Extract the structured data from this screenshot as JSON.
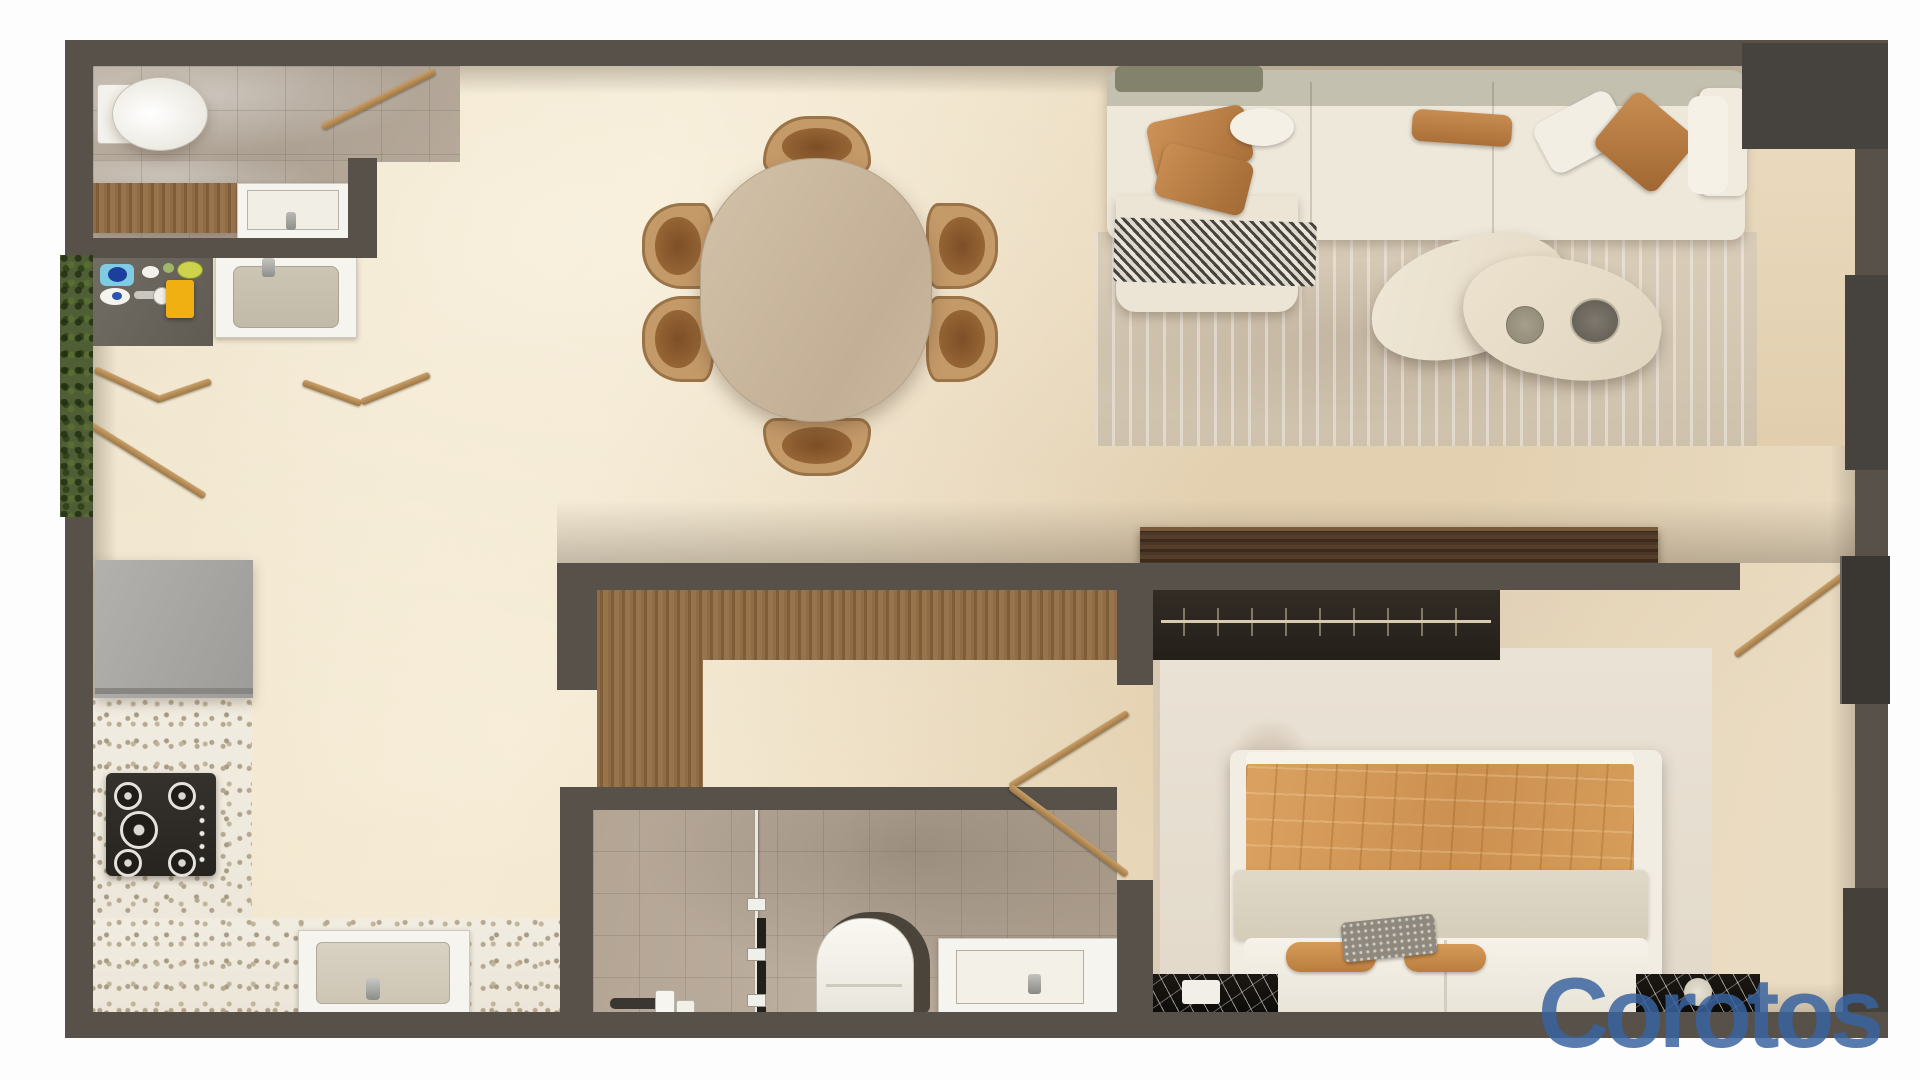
{
  "watermark": {
    "text": "Corotos",
    "color": "#3863a0"
  },
  "palette": {
    "wall": "#57514a",
    "floor_beige": "#ebdcbf",
    "bath_tile": "#b5a99c",
    "wood_door": "#b78a4e",
    "wood_floor": "#8d6b45",
    "walnut_console": "#4b3727",
    "terrazzo": "#f0ebe1",
    "sofa_cream": "#eee8da",
    "pillow_tan": "#c08449",
    "rug": "#d7cbb7",
    "bed_duvet": "#d49a58",
    "nightstand_marble": "#15120e",
    "garden_green": "#4f5e35",
    "fridge_gray": "#a9a8a4"
  }
}
